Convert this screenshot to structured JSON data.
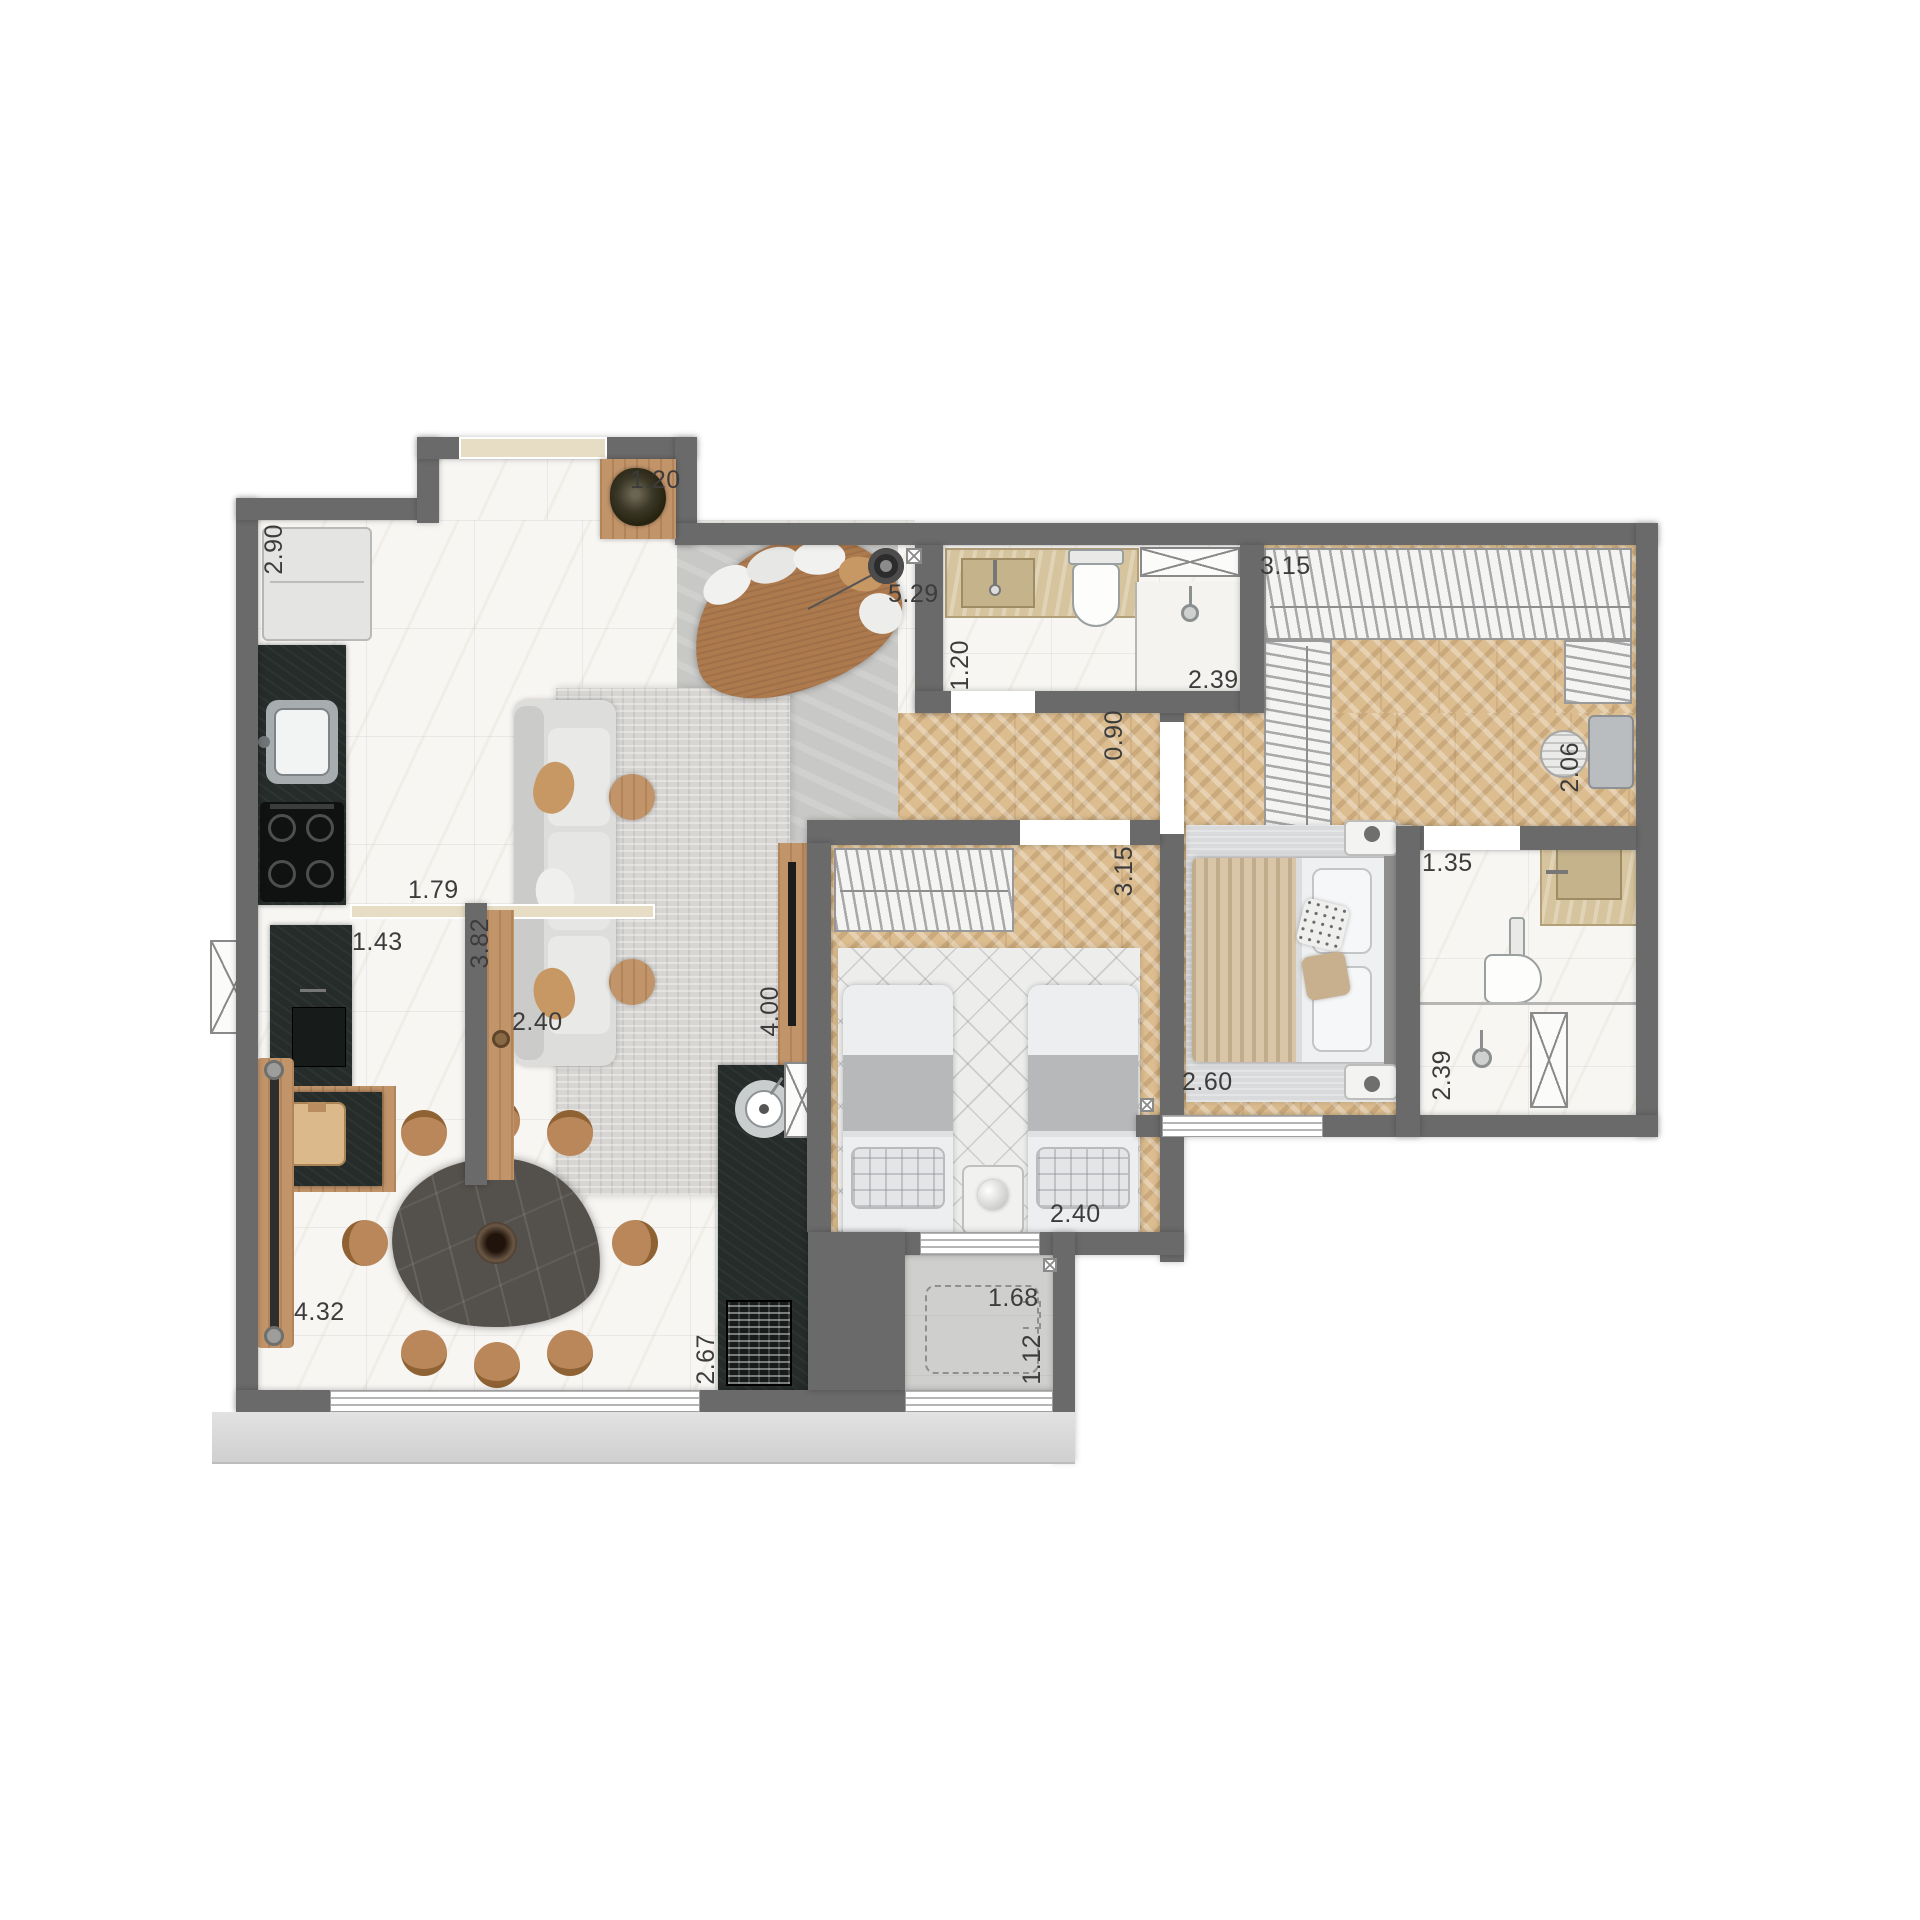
{
  "plan": {
    "type": "apartment-floor-plan",
    "colors": {
      "wall": "#6a6a6a",
      "marble_floor": "#f7f6f3",
      "wood_chevron_floor": "#dcbd90",
      "concrete_floor": "#c8c8c6",
      "dark_counter": "#262c2a",
      "travertine": "#d6c49e",
      "furniture_wood": "#c2946a",
      "leather": "#ad7a4e",
      "apron": "#d9d9d9"
    },
    "dimensions": [
      {
        "id": "kitchen-depth",
        "value": "2.90",
        "orientation": "vertical"
      },
      {
        "id": "entry-mat",
        "value": "1.20",
        "orientation": "horizontal"
      },
      {
        "id": "living-width",
        "value": "5.29",
        "orientation": "horizontal"
      },
      {
        "id": "kitchen-pass",
        "value": "1.79",
        "orientation": "horizontal"
      },
      {
        "id": "laundry-pass",
        "value": "1.43",
        "orientation": "horizontal"
      },
      {
        "id": "living-depth-west",
        "value": "3.82",
        "orientation": "vertical"
      },
      {
        "id": "sofa-length",
        "value": "2.40",
        "orientation": "horizontal"
      },
      {
        "id": "living-depth-east",
        "value": "4.00",
        "orientation": "vertical"
      },
      {
        "id": "bath-social-width",
        "value": "1.20",
        "orientation": "vertical"
      },
      {
        "id": "bath-social-length",
        "value": "2.39",
        "orientation": "horizontal"
      },
      {
        "id": "hall-door",
        "value": "0.90",
        "orientation": "vertical"
      },
      {
        "id": "closet-width",
        "value": "3.15",
        "orientation": "horizontal"
      },
      {
        "id": "desk-nook",
        "value": "2.06",
        "orientation": "vertical"
      },
      {
        "id": "master-bath-width",
        "value": "1.35",
        "orientation": "horizontal"
      },
      {
        "id": "bedroom2-depth",
        "value": "3.15",
        "orientation": "vertical"
      },
      {
        "id": "master-bed-width",
        "value": "2.60",
        "orientation": "horizontal"
      },
      {
        "id": "master-bath-length",
        "value": "2.39",
        "orientation": "vertical"
      },
      {
        "id": "bedroom2-width",
        "value": "2.40",
        "orientation": "horizontal"
      },
      {
        "id": "balcony-length",
        "value": "1.68",
        "orientation": "horizontal"
      },
      {
        "id": "balcony-width",
        "value": "1.12",
        "orientation": "vertical"
      },
      {
        "id": "dining-length",
        "value": "4.32",
        "orientation": "horizontal"
      },
      {
        "id": "dining-width",
        "value": "2.67",
        "orientation": "vertical"
      }
    ]
  }
}
